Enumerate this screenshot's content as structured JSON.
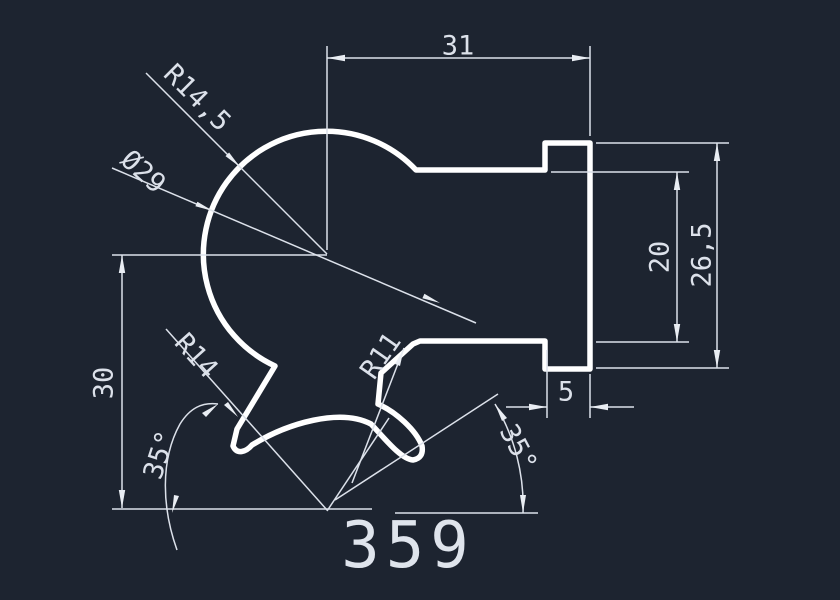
{
  "drawing": {
    "part_number": "359",
    "dimensions": {
      "top_width": "31",
      "flange_inner_height": "20",
      "flange_outer_height": "26,5",
      "flange_tab_width": "5",
      "left_height": "30",
      "angle_left": "35°",
      "angle_right": "35°",
      "main_radius": "R14,5",
      "bore_diameter": "Ø29",
      "left_fillet_radius": "R14",
      "right_fillet_radius": "R11"
    },
    "colors": {
      "background": "#1d2430",
      "outline": "#ffffff",
      "dimension": "#dce1ea"
    }
  }
}
